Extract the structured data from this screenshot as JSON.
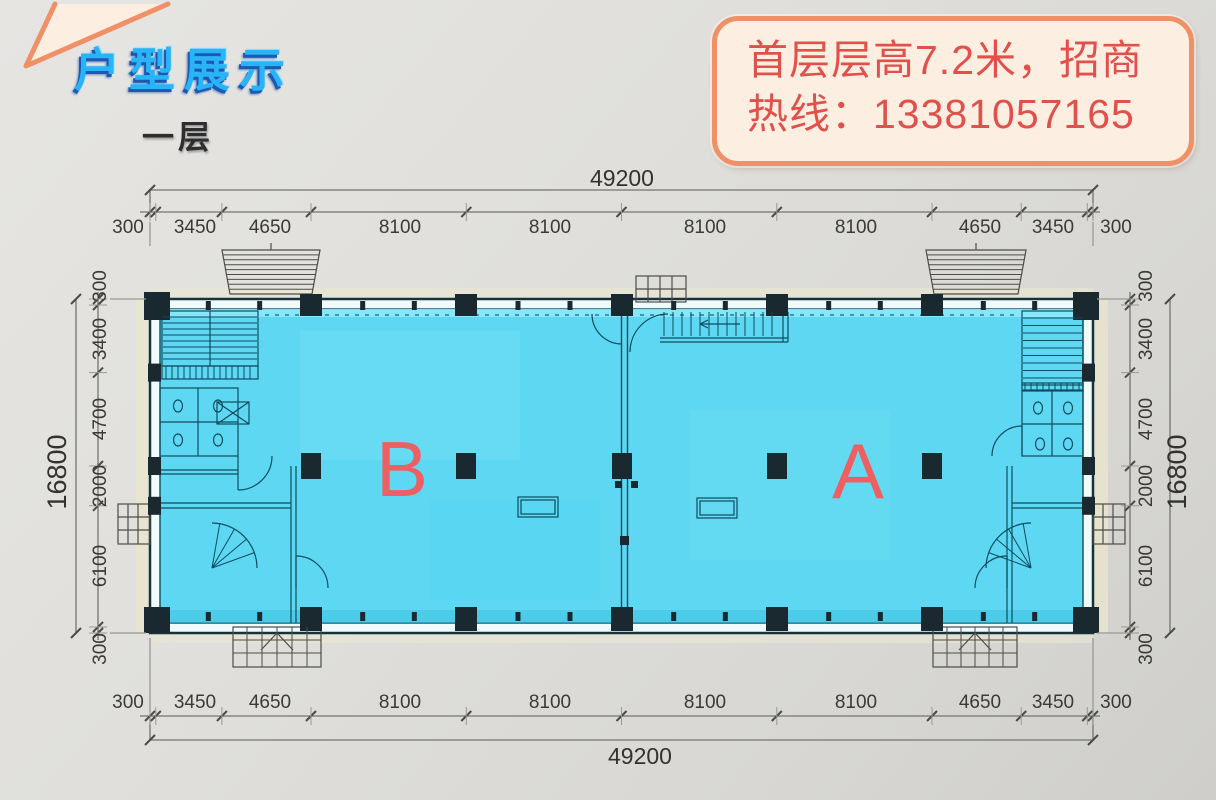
{
  "header": {
    "title": "户型展示",
    "floor_label": "一层"
  },
  "callout": {
    "lines": [
      "首层层高7.2米，招商",
      "热线：13381057165"
    ]
  },
  "units": {
    "left_label": "B",
    "right_label": "A"
  },
  "dimensions": {
    "top": {
      "total": "49200",
      "segments": [
        "300",
        "3450",
        "4650",
        "8100",
        "8100",
        "8100",
        "8100",
        "4650",
        "3450",
        "300"
      ]
    },
    "bottom": {
      "total": "49200",
      "segments": [
        "300",
        "3450",
        "4650",
        "8100",
        "8100",
        "8100",
        "8100",
        "4650",
        "3450",
        "300"
      ]
    },
    "left": {
      "total": "16800",
      "segments": [
        "300",
        "3400",
        "4700",
        "2000",
        "6100",
        "300"
      ]
    },
    "right": {
      "total": "16800",
      "segments": [
        "300",
        "3400",
        "4700",
        "2000",
        "6100",
        "300"
      ]
    }
  },
  "colors": {
    "title_blue": "#28b4f6",
    "callout_border": "#f09066",
    "callout_text": "#e2504b",
    "plan_fill": "#5ed8f2",
    "unit_label": "#ee5f64"
  }
}
